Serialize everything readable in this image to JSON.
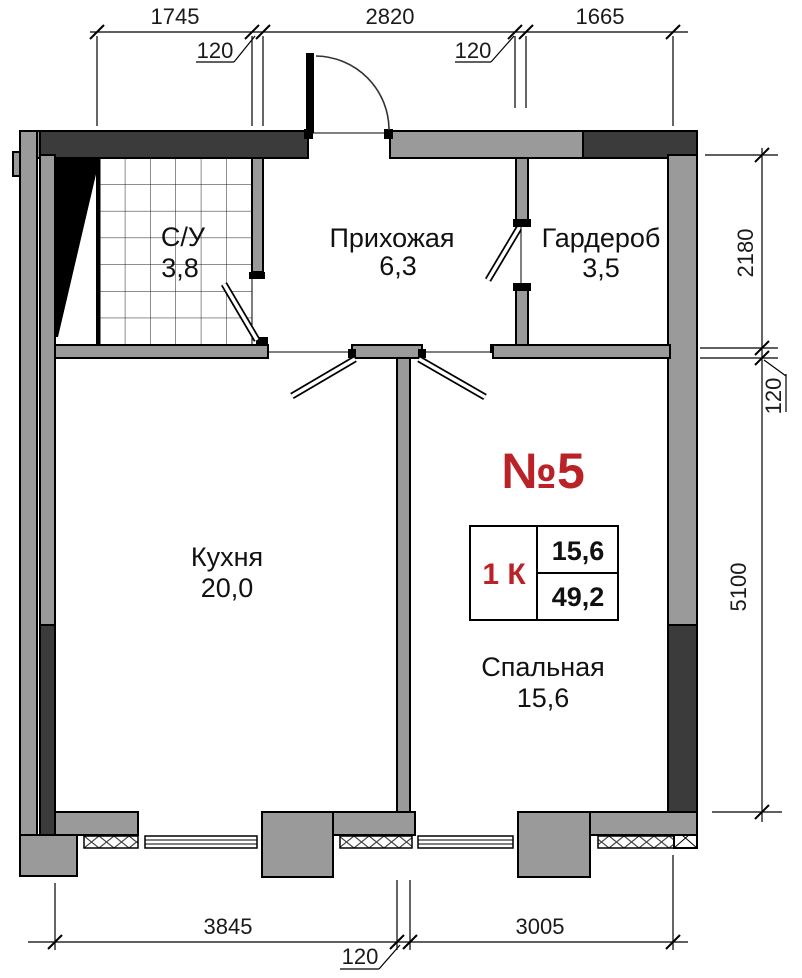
{
  "plan": {
    "apartment_number": "№5",
    "summary_table": {
      "rooms_count": "1 К",
      "living_area": "15,6",
      "total_area": "49,2"
    },
    "rooms": {
      "bathroom": {
        "name": "С/У",
        "area": "3,8"
      },
      "hallway": {
        "name": "Прихожая",
        "area": "6,3"
      },
      "wardrobe": {
        "name": "Гардероб",
        "area": "3,5"
      },
      "kitchen": {
        "name": "Кухня",
        "area": "20,0"
      },
      "bedroom": {
        "name": "Спальная",
        "area": "15,6"
      }
    },
    "dimensions": {
      "top": [
        "1745",
        "120",
        "2820",
        "120",
        "1665"
      ],
      "right": [
        "2180",
        "120",
        "5100"
      ],
      "bottom": [
        "3845",
        "120",
        "3005"
      ]
    },
    "colors": {
      "wall_gray": "#9a9a9a",
      "wall_dark": "#3b3b3b",
      "accent_red": "#b92328"
    }
  }
}
